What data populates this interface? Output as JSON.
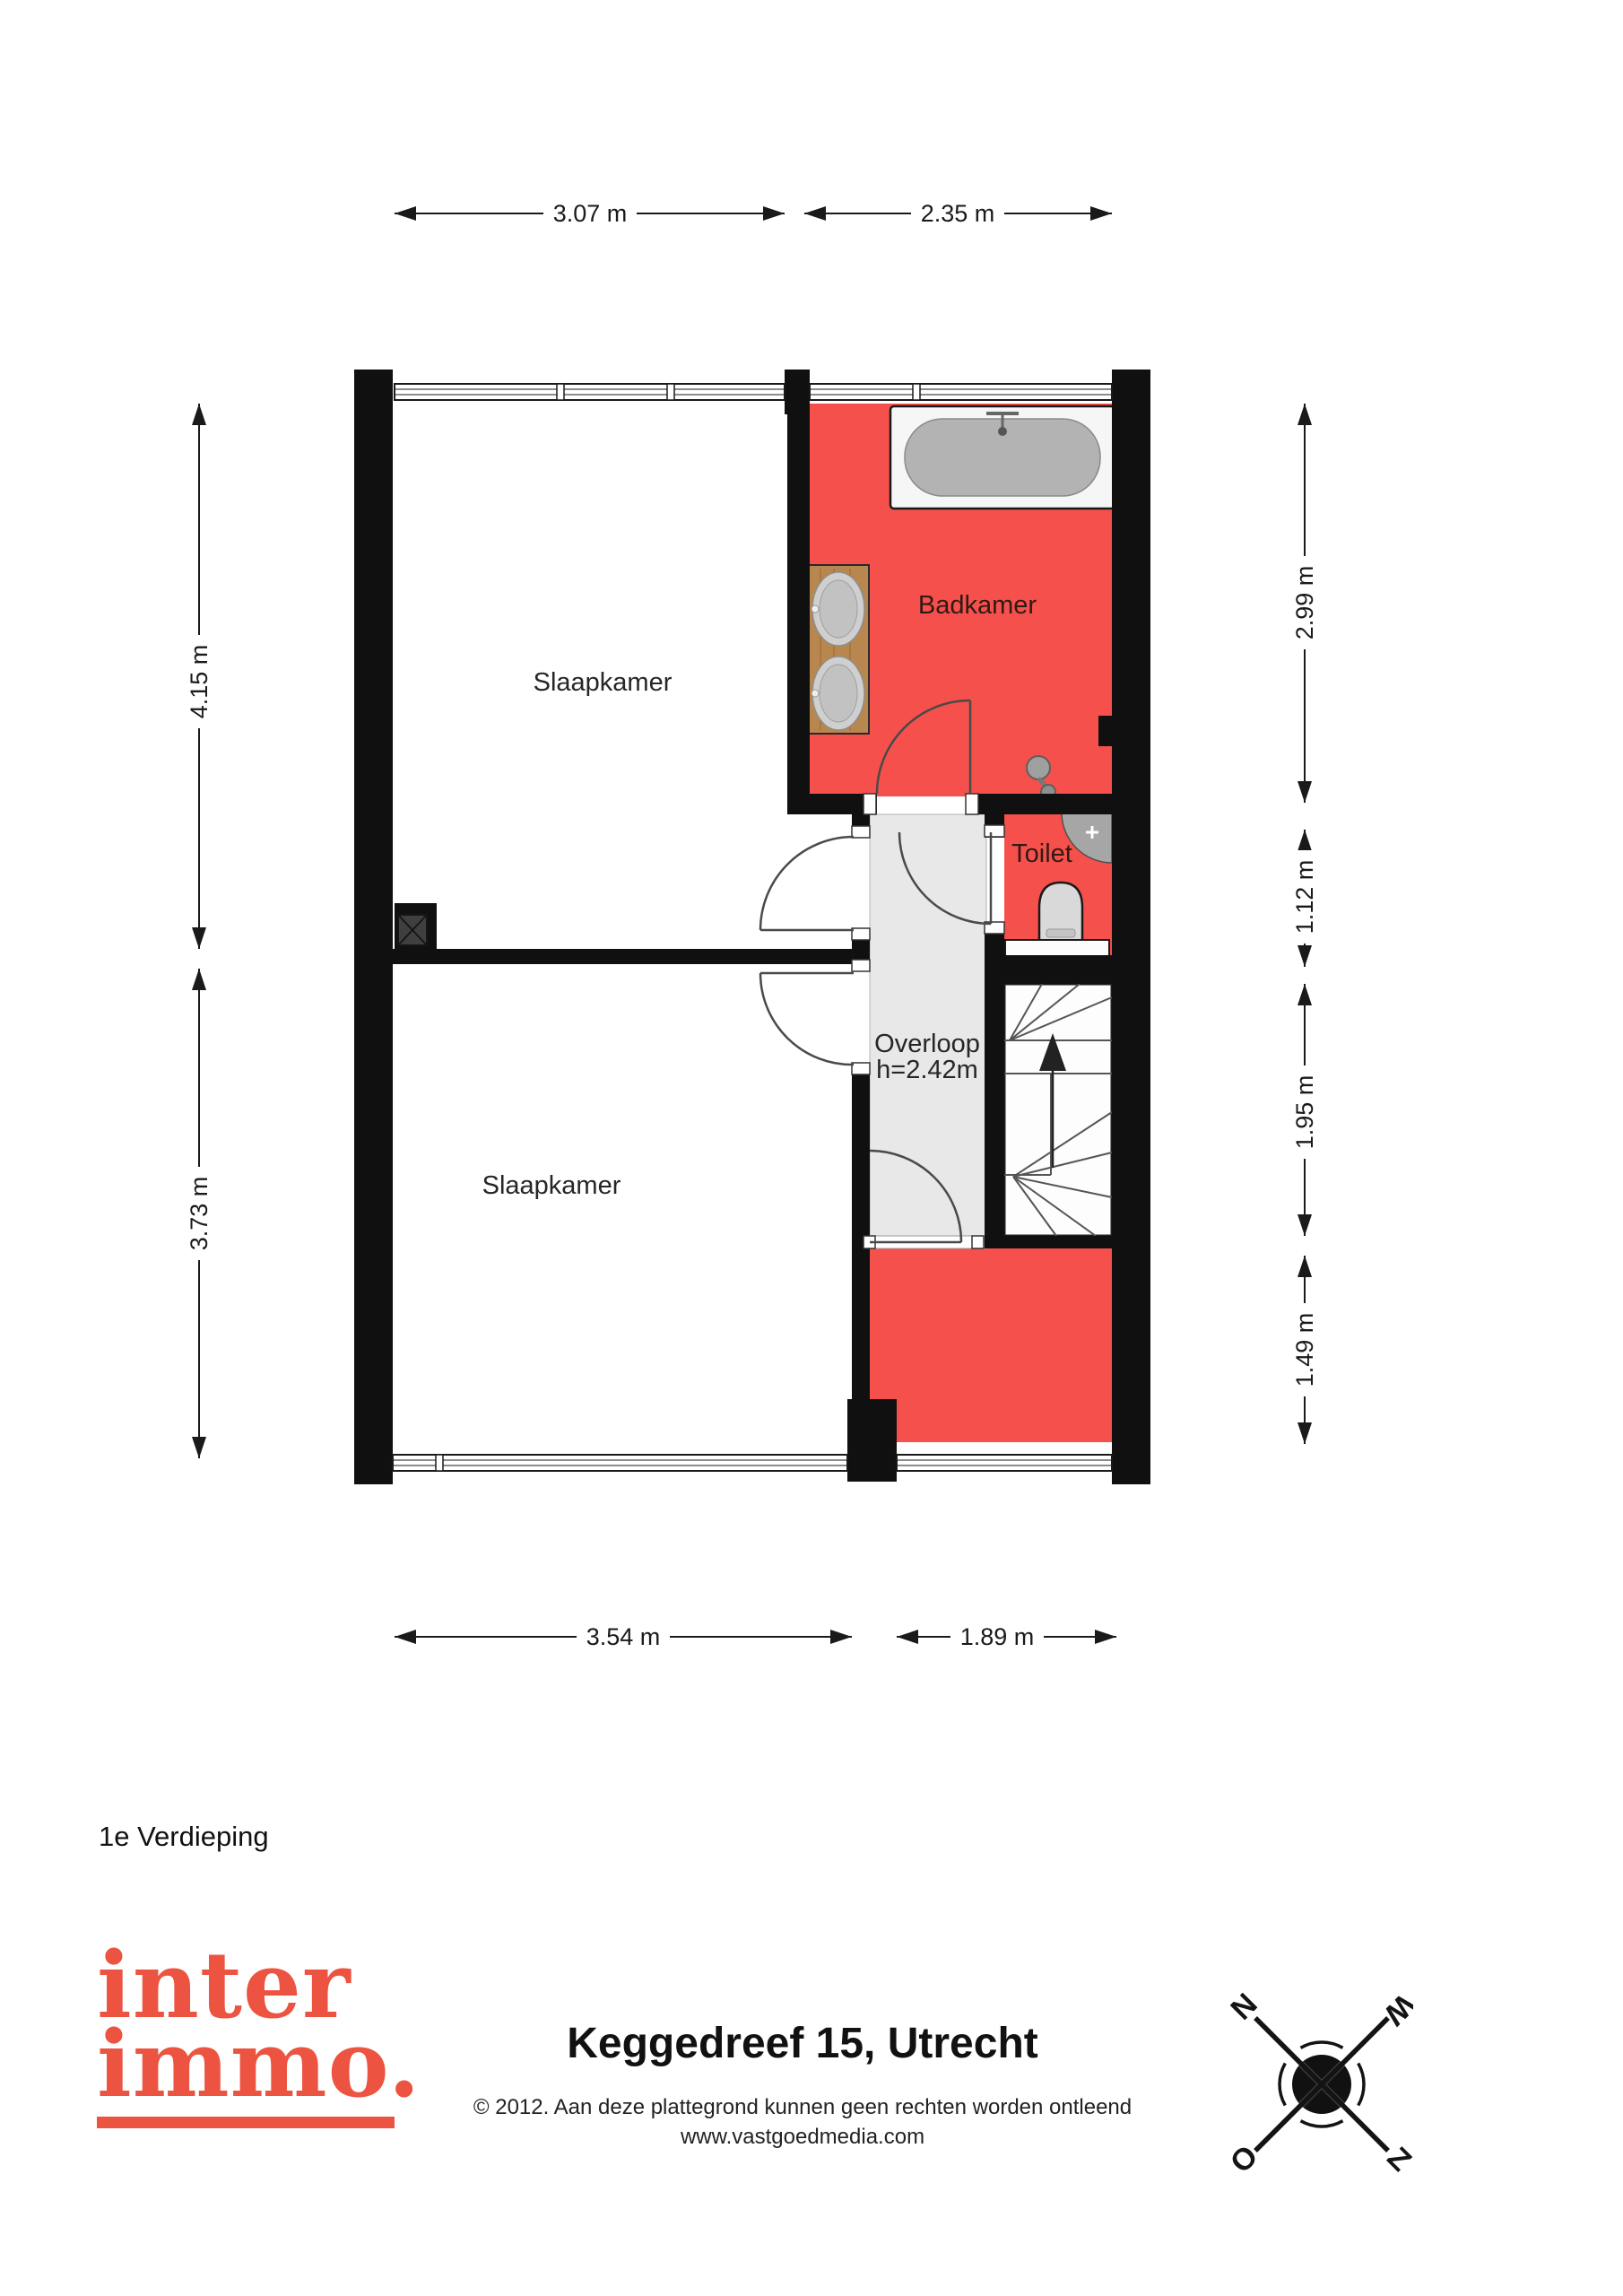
{
  "plan": {
    "floor_label": "1e Verdieping",
    "rooms": {
      "bedroom_top": "Slaapkamer",
      "bedroom_bottom": "Slaapkamer",
      "bathroom": "Badkamer",
      "toilet": "Toilet",
      "landing": "Overloop",
      "landing_height": "h=2.42m"
    },
    "dimensions": {
      "top": [
        "3.07 m",
        "2.35 m"
      ],
      "bottom": [
        "3.54 m",
        "1.89 m"
      ],
      "left": [
        "4.15 m",
        "3.73 m"
      ],
      "right": [
        "2.99 m",
        "1.12 m",
        "1.95 m",
        "1.49 m"
      ]
    },
    "colors": {
      "wet_room_floor": "#f5504b",
      "landing_floor": "#e8e8e8",
      "wall": "#101010",
      "logo": "#ec5340"
    }
  },
  "footer": {
    "logo_line1": "inter",
    "logo_line2": "immo.",
    "title": "Keggedreef 15, Utrecht",
    "copyright": "© 2012. Aan deze plattegrond kunnen geen rechten worden ontleend",
    "website": "www.vastgoedmedia.com"
  },
  "compass": {
    "north": "N",
    "west": "W",
    "east": "O",
    "south": "Z"
  }
}
